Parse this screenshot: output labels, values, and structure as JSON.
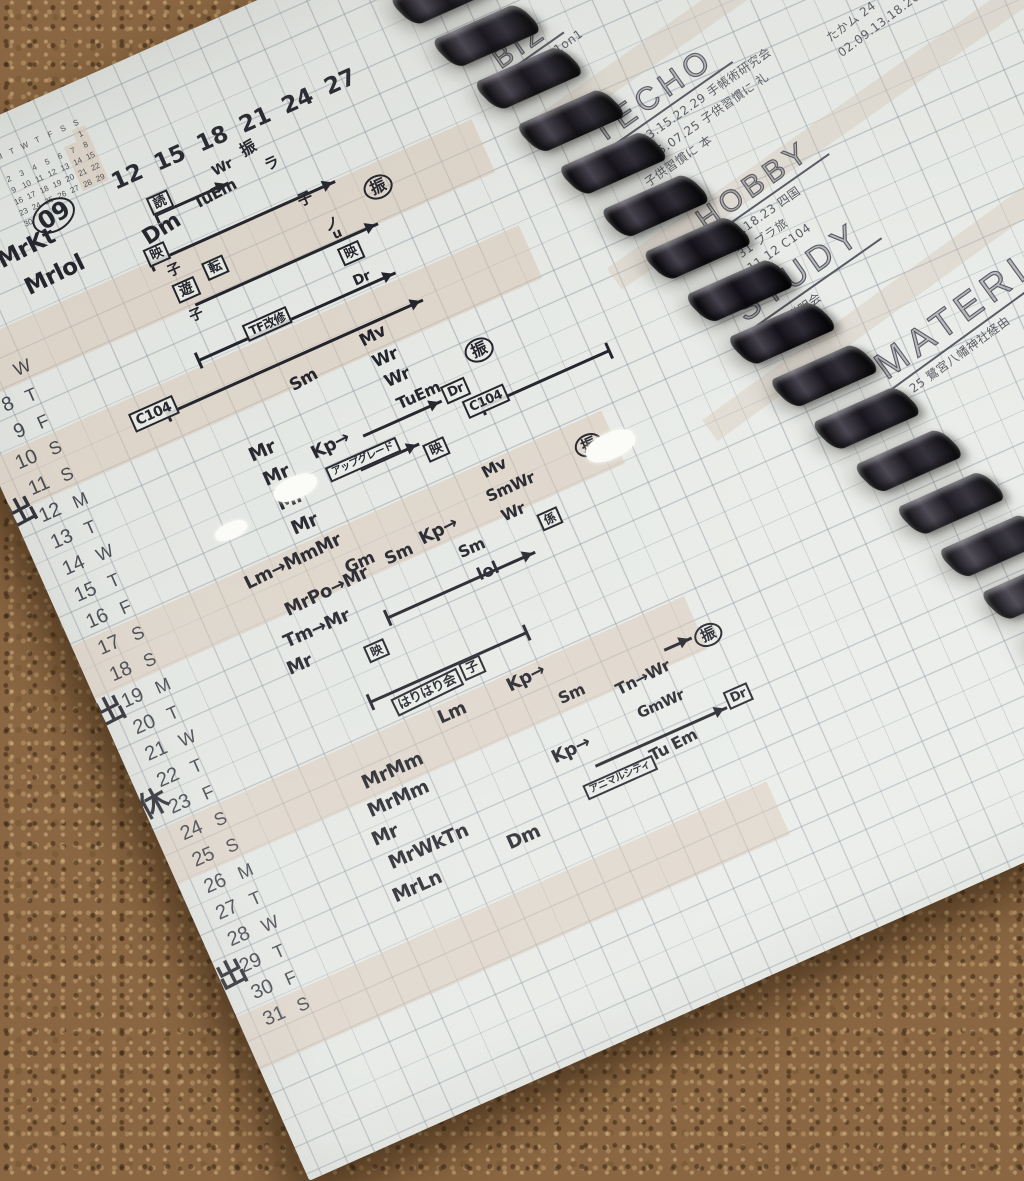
{
  "scene": {
    "description": "spiral-bound grid planner notebook photographed on a cork board",
    "colors": {
      "ink": "#23232b",
      "pencil": "#5b5c64",
      "paper": "#e9ece8",
      "cork": "#8a6642",
      "weekend_band": "#d8c4b2"
    }
  },
  "mini_calendar": {
    "month_label": "9",
    "day_headers": [
      "M",
      "T",
      "W",
      "T",
      "F",
      "S",
      "S"
    ],
    "weeks": [
      [
        "",
        "",
        "",
        "",
        "",
        "",
        "1"
      ],
      [
        "2",
        "3",
        "4",
        "5",
        "6",
        "7",
        "8"
      ],
      [
        "9",
        "10",
        "11",
        "12",
        "13",
        "14",
        "15"
      ],
      [
        "16",
        "17",
        "18",
        "19",
        "20",
        "21",
        "22"
      ],
      [
        "23",
        "24",
        "25",
        "26",
        "27",
        "28",
        "29"
      ],
      [
        "30",
        "",
        "",
        "",
        "",
        "",
        ""
      ]
    ]
  },
  "top_axis_labels": [
    "12",
    "15",
    "18",
    "21",
    "24",
    "27"
  ],
  "date_rows": [
    {
      "d": "7",
      "w": "W"
    },
    {
      "d": "8",
      "w": "T"
    },
    {
      "d": "9",
      "w": "F"
    },
    {
      "d": "10",
      "w": "S"
    },
    {
      "d": "11",
      "w": "S"
    },
    {
      "d": "12",
      "w": "M"
    },
    {
      "d": "13",
      "w": "T"
    },
    {
      "d": "14",
      "w": "W"
    },
    {
      "d": "15",
      "w": "T"
    },
    {
      "d": "16",
      "w": "F"
    },
    {
      "d": "17",
      "w": "S"
    },
    {
      "d": "18",
      "w": "S"
    },
    {
      "d": "19",
      "w": "M"
    },
    {
      "d": "20",
      "w": "T"
    },
    {
      "d": "21",
      "w": "W"
    },
    {
      "d": "22",
      "w": "T"
    },
    {
      "d": "23",
      "w": "F"
    },
    {
      "d": "24",
      "w": "S"
    },
    {
      "d": "25",
      "w": "S"
    },
    {
      "d": "26",
      "w": "M"
    },
    {
      "d": "27",
      "w": "T"
    },
    {
      "d": "28",
      "w": "W"
    },
    {
      "d": "29",
      "w": "T"
    },
    {
      "d": "30",
      "w": "F"
    },
    {
      "d": "31",
      "w": "S"
    }
  ],
  "annotations": [
    {
      "t": "09",
      "x": 136,
      "y": 98,
      "fs": 24,
      "cls": "circled",
      "rot": -8
    },
    {
      "t": "MrKt",
      "x": 90,
      "y": 122,
      "fs": 23,
      "rot": -3
    },
    {
      "t": "Mrlol",
      "x": 104,
      "y": 158,
      "fs": 23,
      "rot": -2
    },
    {
      "t": "Dm",
      "x": 232,
      "y": 160,
      "fs": 22,
      "rot": -8
    },
    {
      "t": "読",
      "x": 250,
      "y": 136,
      "fs": 13,
      "cls": "box"
    },
    {
      "t": "TuEm",
      "x": 292,
      "y": 152,
      "fs": 16,
      "rot": -4
    },
    {
      "t": "Wr",
      "x": 322,
      "y": 132,
      "fs": 14,
      "rot": -4
    },
    {
      "t": "振",
      "x": 356,
      "y": 124,
      "fs": 16,
      "rot": -6
    },
    {
      "t": "ラ",
      "x": 372,
      "y": 148,
      "fs": 15
    },
    {
      "t": "子",
      "x": 388,
      "y": 194,
      "fs": 15
    },
    {
      "t": "ノ",
      "x": 402,
      "y": 228,
      "fs": 15
    },
    {
      "t": "映",
      "x": 226,
      "y": 182,
      "fs": 13,
      "cls": "box"
    },
    {
      "t": "子",
      "x": 240,
      "y": 206,
      "fs": 14
    },
    {
      "t": "遊",
      "x": 238,
      "y": 226,
      "fs": 14,
      "cls": "box"
    },
    {
      "t": "子",
      "x": 242,
      "y": 256,
      "fs": 14
    },
    {
      "t": "転",
      "x": 274,
      "y": 218,
      "fs": 13,
      "cls": "box"
    },
    {
      "t": "振",
      "x": 452,
      "y": 208,
      "fs": 16,
      "cls": "circled"
    },
    {
      "t": "u",
      "x": 406,
      "y": 240,
      "fs": 13
    },
    {
      "t": "映",
      "x": 404,
      "y": 260,
      "fs": 13,
      "cls": "box"
    },
    {
      "t": "Dr",
      "x": 406,
      "y": 290,
      "fs": 14
    },
    {
      "t": "TF改修",
      "x": 286,
      "y": 291,
      "fs": 12,
      "cls": "box"
    },
    {
      "t": "C104",
      "x": 146,
      "y": 326,
      "fs": 14,
      "cls": "box"
    },
    {
      "t": "Sm",
      "x": 306,
      "y": 358,
      "fs": 17,
      "rot": -5
    },
    {
      "t": "Mv",
      "x": 388,
      "y": 346,
      "fs": 17,
      "rot": -4
    },
    {
      "t": "Wr",
      "x": 391,
      "y": 371,
      "fs": 17
    },
    {
      "t": "Wr",
      "x": 394,
      "y": 394,
      "fs": 17
    },
    {
      "t": "TuEm",
      "x": 396,
      "y": 419,
      "fs": 16
    },
    {
      "t": "Kp→",
      "x": 298,
      "y": 428,
      "fs": 18,
      "rot": -3
    },
    {
      "t": "アップグレード",
      "x": 304,
      "y": 455,
      "fs": 10,
      "cls": "box"
    },
    {
      "t": "映",
      "x": 402,
      "y": 474,
      "fs": 13,
      "cls": "box"
    },
    {
      "t": "Dr",
      "x": 442,
      "y": 428,
      "fs": 13,
      "cls": "box"
    },
    {
      "t": "振",
      "x": 478,
      "y": 398,
      "fs": 16,
      "cls": "circled"
    },
    {
      "t": "C104",
      "x": 456,
      "y": 450,
      "fs": 13,
      "cls": "box"
    },
    {
      "t": "Mv",
      "x": 446,
      "y": 516,
      "fs": 16,
      "rot": -4
    },
    {
      "t": "SmWr",
      "x": 440,
      "y": 540,
      "fs": 16
    },
    {
      "t": "Wr",
      "x": 446,
      "y": 564,
      "fs": 16
    },
    {
      "t": "振",
      "x": 540,
      "y": 530,
      "fs": 15,
      "cls": "circled"
    },
    {
      "t": "係",
      "x": 478,
      "y": 584,
      "fs": 12,
      "cls": "box"
    },
    {
      "t": "Kp→",
      "x": 362,
      "y": 550,
      "fs": 18,
      "rot": -3
    },
    {
      "t": "Sm",
      "x": 392,
      "y": 580,
      "fs": 16
    },
    {
      "t": "lol",
      "x": 400,
      "y": 608,
      "fs": 17
    },
    {
      "t": "Mr",
      "x": 240,
      "y": 405,
      "fs": 19
    },
    {
      "t": "Mr",
      "x": 243,
      "y": 433,
      "fs": 19
    },
    {
      "t": "Mr",
      "x": 246,
      "y": 461,
      "fs": 19
    },
    {
      "t": "Mr",
      "x": 249,
      "y": 489,
      "fs": 19
    },
    {
      "t": "Lm→MmMr",
      "x": 184,
      "y": 519,
      "fs": 18,
      "rot": -2
    },
    {
      "t": "Gm",
      "x": 282,
      "y": 548,
      "fs": 17
    },
    {
      "t": "Sm",
      "x": 322,
      "y": 556,
      "fs": 17
    },
    {
      "t": "MrPo→Mr",
      "x": 210,
      "y": 560,
      "fs": 18,
      "rot": -2
    },
    {
      "t": "Tm→Mr",
      "x": 196,
      "y": 590,
      "fs": 18
    },
    {
      "t": "Mr",
      "x": 188,
      "y": 616,
      "fs": 18
    },
    {
      "t": "映",
      "x": 266,
      "y": 634,
      "fs": 12,
      "cls": "box"
    },
    {
      "t": "はりはり会",
      "x": 270,
      "y": 692,
      "fs": 13,
      "cls": "box",
      "rot": -2
    },
    {
      "t": "子",
      "x": 346,
      "y": 688,
      "fs": 13,
      "cls": "box"
    },
    {
      "t": "Kp→",
      "x": 382,
      "y": 720,
      "fs": 18,
      "rot": -3
    },
    {
      "t": "Sm",
      "x": 424,
      "y": 754,
      "fs": 16
    },
    {
      "t": "Lm",
      "x": 306,
      "y": 722,
      "fs": 18
    },
    {
      "t": "Tn→Wr",
      "x": 480,
      "y": 768,
      "fs": 16,
      "rot": -3
    },
    {
      "t": "GmWr",
      "x": 490,
      "y": 800,
      "fs": 15
    },
    {
      "t": "Kp→",
      "x": 394,
      "y": 804,
      "fs": 18,
      "rot": -2
    },
    {
      "t": "Tu Em",
      "x": 484,
      "y": 842,
      "fs": 16,
      "rot": -3
    },
    {
      "t": "アニマルシティ",
      "x": 410,
      "y": 850,
      "fs": 10,
      "cls": "box"
    },
    {
      "t": "Dr",
      "x": 576,
      "y": 822,
      "fs": 13,
      "cls": "box"
    },
    {
      "t": "振",
      "x": 572,
      "y": 752,
      "fs": 15,
      "cls": "circled"
    },
    {
      "t": "MrMm",
      "x": 210,
      "y": 750,
      "fs": 19
    },
    {
      "t": "MrMm",
      "x": 204,
      "y": 778,
      "fs": 19
    },
    {
      "t": "Mr",
      "x": 196,
      "y": 806,
      "fs": 19
    },
    {
      "t": "MrWkTn",
      "x": 202,
      "y": 834,
      "fs": 19
    },
    {
      "t": "MrLn",
      "x": 192,
      "y": 866,
      "fs": 19
    },
    {
      "t": "Dm",
      "x": 318,
      "y": 864,
      "fs": 19
    },
    {
      "t": "出",
      "x": -6,
      "y": 358,
      "fs": 30,
      "cls": "stamp",
      "rot": -4
    },
    {
      "t": "出",
      "x": -6,
      "y": 576,
      "fs": 30,
      "cls": "stamp",
      "rot": -3
    },
    {
      "t": "休",
      "x": -4,
      "y": 678,
      "fs": 30,
      "cls": "stamp",
      "rot": -5
    },
    {
      "t": "出",
      "x": -2,
      "y": 866,
      "fs": 30,
      "cls": "stamp",
      "rot": -3
    }
  ],
  "arrows": [
    {
      "x": 228,
      "y": 196,
      "w": 202,
      "cls": "tl hr"
    },
    {
      "x": 252,
      "y": 154,
      "w": 80,
      "cls": "tl hr"
    },
    {
      "x": 252,
      "y": 252,
      "w": 200,
      "cls": "hr"
    },
    {
      "x": 232,
      "y": 304,
      "w": 216,
      "cls": "tl hr"
    },
    {
      "x": 182,
      "y": 340,
      "w": 280,
      "cls": "tl hr"
    },
    {
      "x": 352,
      "y": 440,
      "w": 86,
      "cls": "hr"
    },
    {
      "x": 472,
      "y": 462,
      "w": 140,
      "cls": "tl tr"
    },
    {
      "x": 336,
      "y": 470,
      "w": 64,
      "cls": "hr"
    },
    {
      "x": 300,
      "y": 616,
      "w": 162,
      "cls": "tl hr"
    },
    {
      "x": 250,
      "y": 686,
      "w": 172,
      "cls": "tl tr"
    },
    {
      "x": 430,
      "y": 836,
      "w": 144,
      "cls": "hr"
    },
    {
      "x": 540,
      "y": 758,
      "w": 30,
      "cls": "hr"
    }
  ],
  "highlight_bands": [
    {
      "y": 196,
      "h": 58
    },
    {
      "y": 312,
      "h": 58
    },
    {
      "y": 515,
      "h": 58
    },
    {
      "y": 718,
      "h": 58
    },
    {
      "y": 921,
      "h": 58
    }
  ],
  "whiteouts": [
    {
      "x": 246,
      "y": 450,
      "w": 46,
      "h": 22
    },
    {
      "x": 548,
      "y": 538,
      "w": 52,
      "h": 26
    },
    {
      "x": 176,
      "y": 466,
      "w": 34,
      "h": 16
    }
  ],
  "right_page": {
    "sections": [
      {
        "id": "top-note",
        "title": "",
        "title_fs": 0,
        "notes": [
          "04",
          "05 歯科"
        ],
        "x": 636,
        "y": 56,
        "rot": -11
      },
      {
        "id": "biz",
        "title": "BIZ",
        "title_fs": 28,
        "notes": [
          "02.02 1on1"
        ],
        "x": 626,
        "y": 130,
        "rot": -11
      },
      {
        "id": "techo",
        "title": "TECHO",
        "title_fs": 32,
        "notes": [
          "01.03.15.22.29 手帳術研究会",
          "04.05.07.25 子供習慣に 礼",
          "子供習慣に 本"
        ],
        "x": 690,
        "y": 226,
        "rot": -11
      },
      {
        "id": "techo-right",
        "title": "",
        "title_fs": 0,
        "notes": [
          "たかム 24",
          "02.09.13.18.26.30 ブカバ"
        ],
        "x": 924,
        "y": 240,
        "rot": -13
      },
      {
        "id": "hobby",
        "title": "HOBBY",
        "title_fs": 30,
        "notes": [
          "04.18.23 四国",
          "31 ブラ旅",
          "11.12 C104"
        ],
        "x": 750,
        "y": 354,
        "rot": -11
      },
      {
        "id": "study",
        "title": "STUDY",
        "title_fs": 34,
        "notes": [
          "成長説明会"
        ],
        "x": 746,
        "y": 450,
        "rot": -11
      },
      {
        "id": "material",
        "title": "MATERIAL",
        "title_fs": 38,
        "notes": [
          "25 鷺宮八幡神社経由"
        ],
        "x": 850,
        "y": 546,
        "rot": -12
      }
    ],
    "bands": [
      {
        "x": 616,
        "y": 170,
        "w": 560,
        "rot": -11
      },
      {
        "x": 640,
        "y": 330,
        "w": 600,
        "rot": -11
      },
      {
        "x": 664,
        "y": 498,
        "w": 640,
        "rot": -12
      }
    ]
  },
  "binding": {
    "coil_count": 20
  }
}
